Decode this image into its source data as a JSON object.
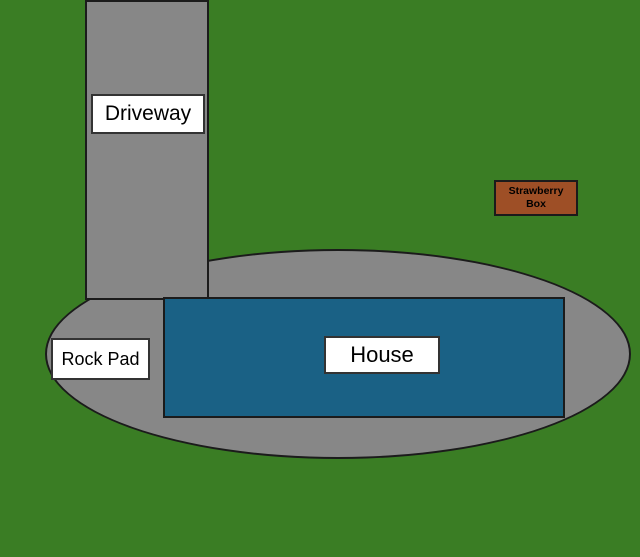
{
  "diagram": {
    "description": "Yard site plan diagram",
    "labels": {
      "driveway": "Driveway",
      "rock_pad": "Rock Pad",
      "house": "House",
      "strawberry_line1": "Strawberry",
      "strawberry_line2": "Box"
    },
    "colors": {
      "grass_green": "#3a7d24",
      "pavement_gray": "#878787",
      "house_blue": "#1a6185",
      "strawberry_brown": "#9e4f26",
      "outline_dark": "#1b1b1b",
      "label_background": "#ffffff",
      "label_text": "#000000"
    }
  }
}
